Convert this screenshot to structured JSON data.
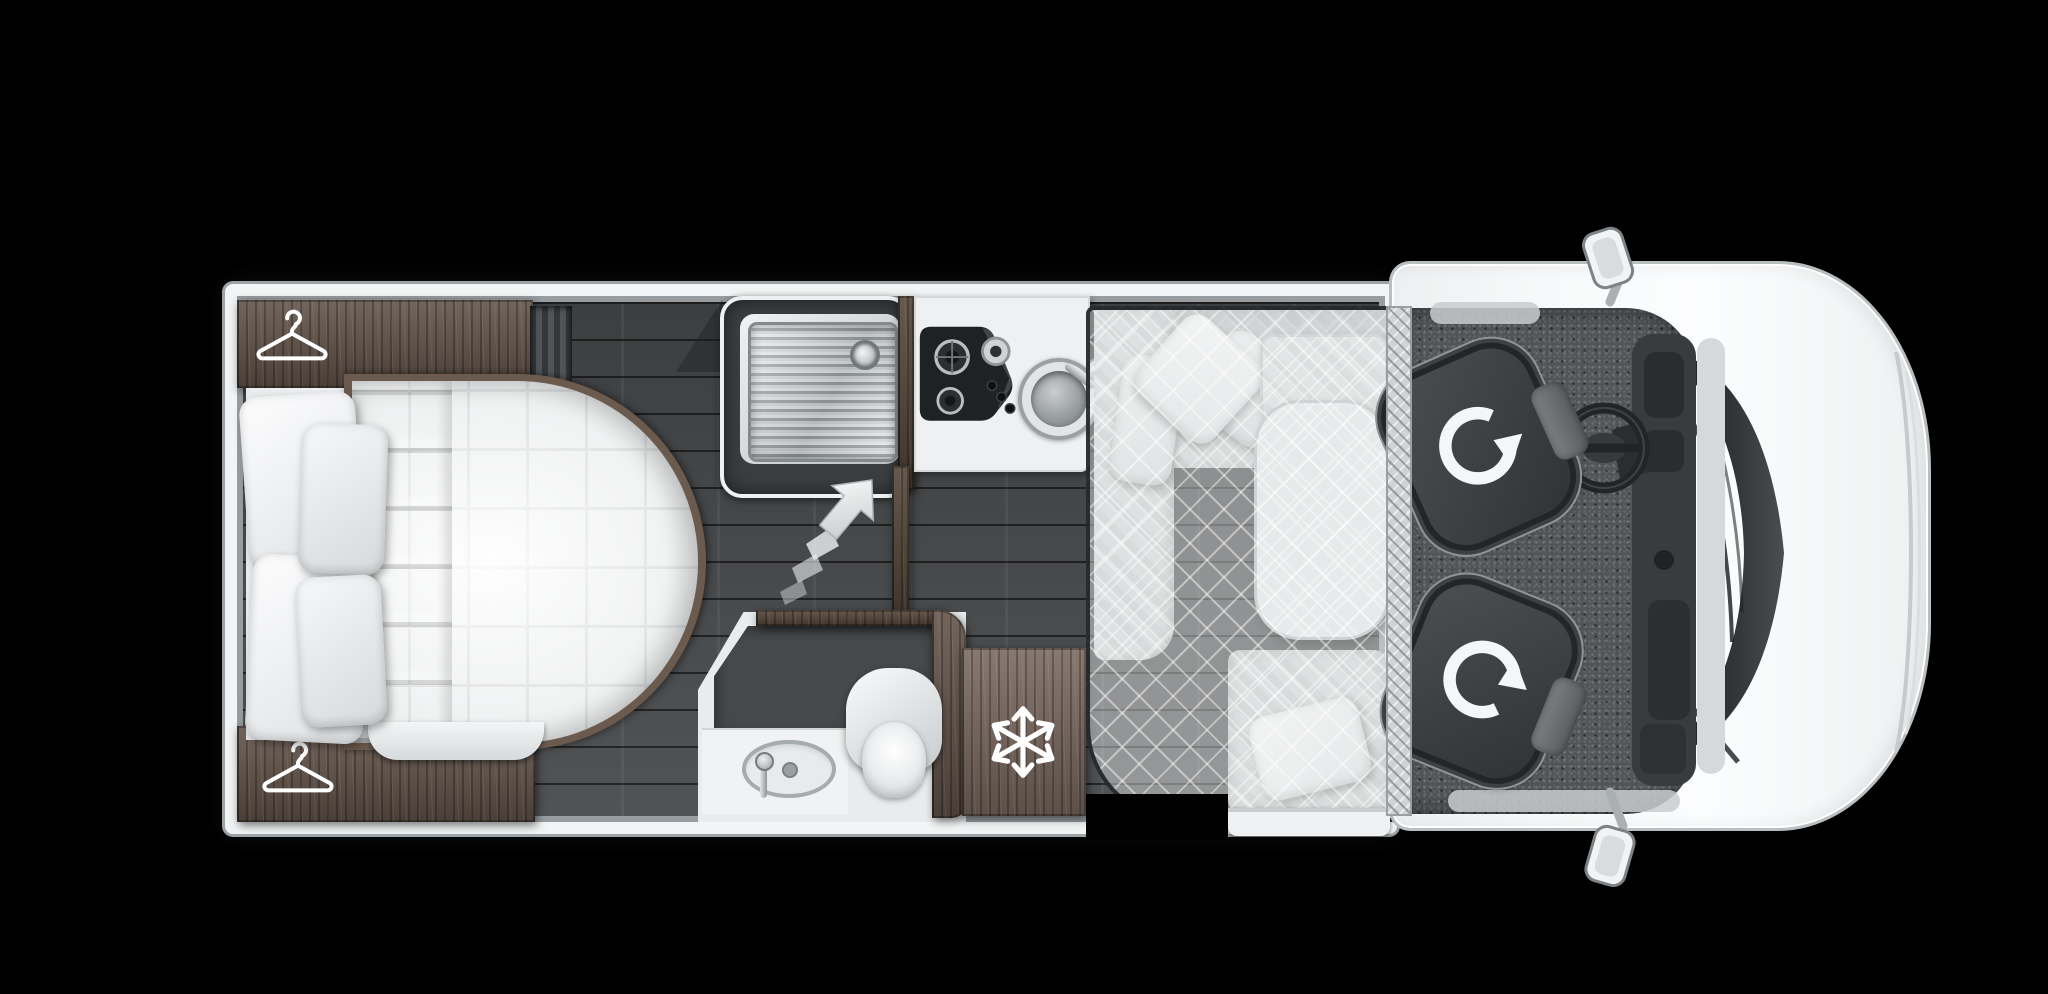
{
  "scene": {
    "label": "Motorhome floor plan, overhead top view",
    "background": "#000000"
  },
  "colors": {
    "background": "#000000",
    "body": "#f5f7f8",
    "wall": "#f2f4f5",
    "wall_edge": "#b9bec1",
    "wall_inner": "#979da0",
    "floor": "#46484a",
    "wood": "#63544a",
    "wood_light": "#7b6a5f",
    "wood_dark": "#554639",
    "bedding": "#f1f3f4",
    "bed_grid": "#c6cacb",
    "fabric": "#d5d8d9",
    "table": "#e6e9ea",
    "film": "rgba(232,235,236,0.45)",
    "film_edge": "rgba(32,35,37,0.92)",
    "shower": "#3b3d3f",
    "tray": "#c6cacc",
    "hob": "#1f2224",
    "counter": "#eef0f1",
    "washroom_floor": "#474a4c",
    "carpet": "#525558",
    "seat": "#3f4346",
    "seat_trim": "#24262a",
    "dash": "#393c3e",
    "glass": "#1a1c1e",
    "chrome": "#c6cacc",
    "icon": "#ffffff",
    "checker": "#cfd3d5",
    "step": "#eef0f2"
  },
  "icons": {
    "hanger_rear": "hanger-icon",
    "hanger_front": "hanger-icon",
    "snowflake": "snowflake-icon",
    "swivel_driver": "rotate-seat-icon",
    "swivel_passenger": "rotate-seat-icon",
    "entry_arrow": "entry-arrow-icon"
  },
  "areas": {
    "bedroom": "island-bed-bedroom",
    "shower": "shower-cubicle",
    "kitchen": "kitchen-hob-and-round-sink",
    "washroom": "washroom-toilet-and-basin",
    "fridge": "refrigerator",
    "dinette": "l-shaped-dinette-with-table",
    "drop_down_bed": "drop-down-bed-outline",
    "cab": "cab-with-swivel-seats",
    "entry": "entrance-door-opening"
  }
}
